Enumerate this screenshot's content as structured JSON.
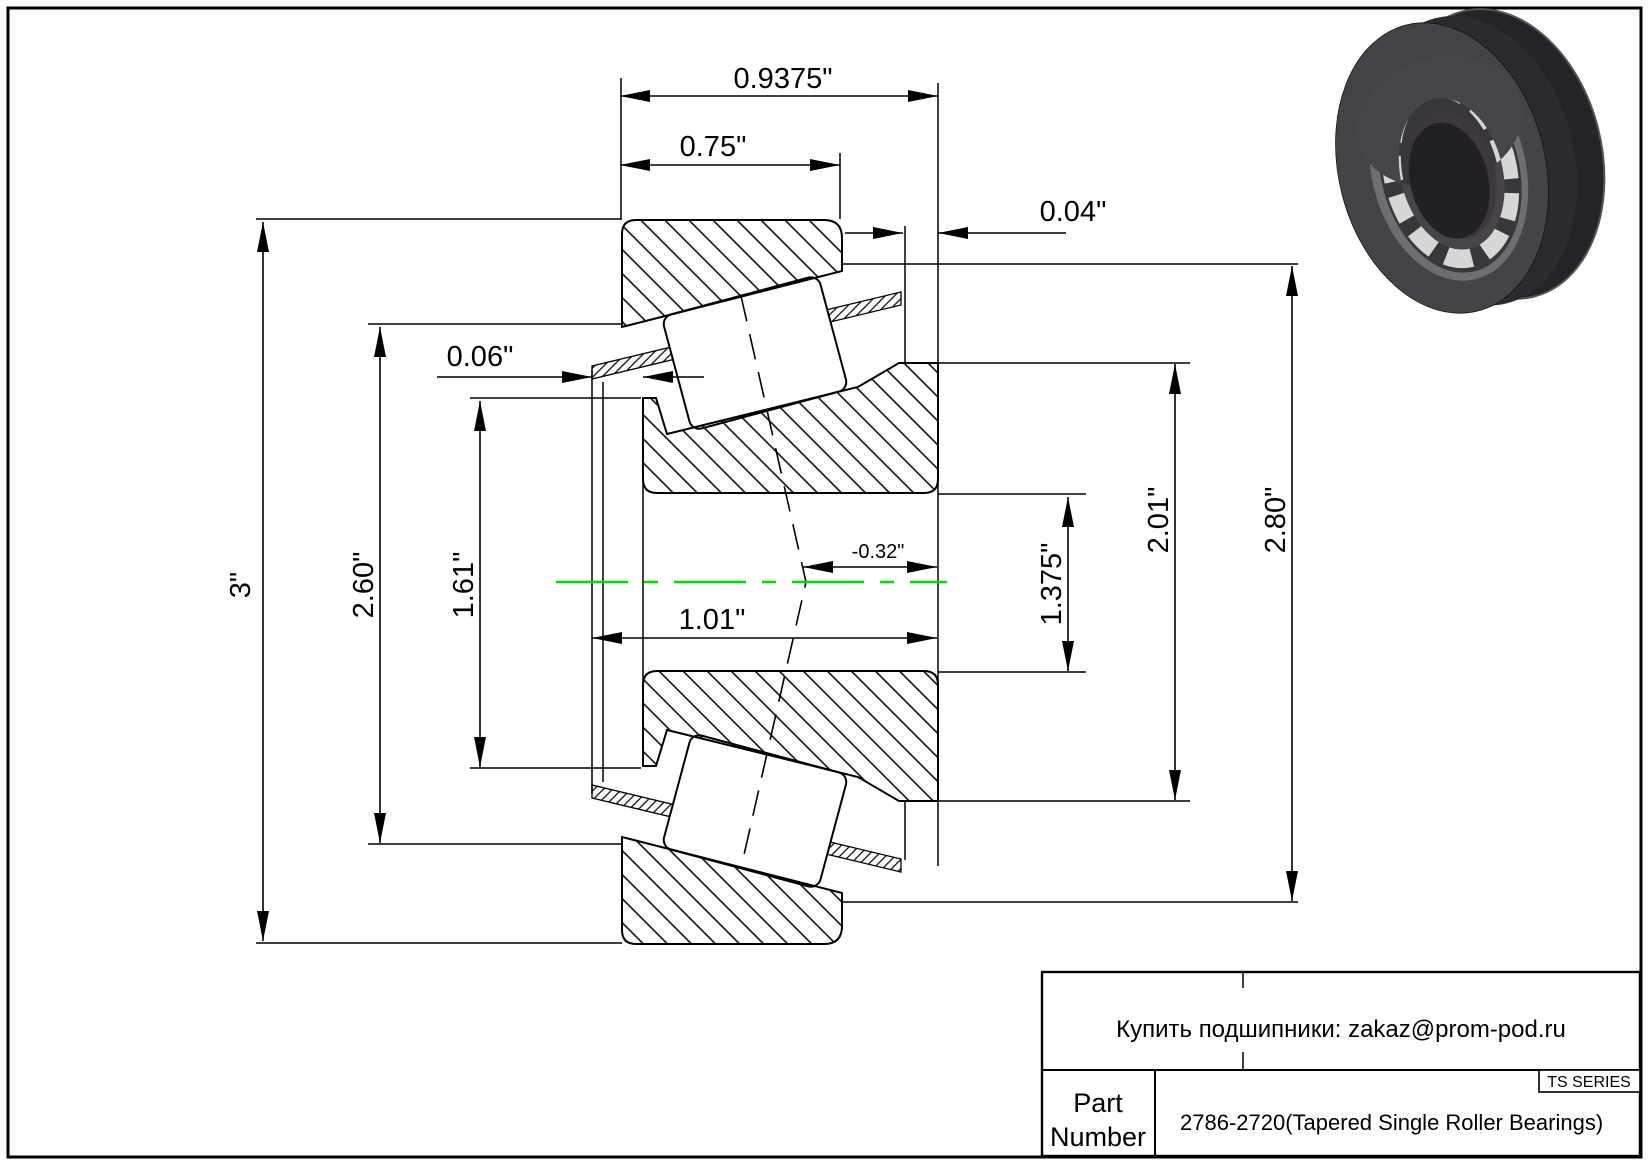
{
  "drawing": {
    "type_note": "Tapered single roller bearing cross-section drawing",
    "colors": {
      "line": "#000000",
      "centerline": "#00dd00",
      "background": "#ffffff",
      "bearing_body": "#3d3b3f",
      "bearing_rollers": "#d7d5d6"
    },
    "dimensions": {
      "horizontal": [
        {
          "id": "overall-width",
          "label": "0.9375\""
        },
        {
          "id": "cup-width",
          "label": "0.75\""
        },
        {
          "id": "back-standout",
          "label": "0.04\""
        },
        {
          "id": "front-standout",
          "label": "0.06\""
        },
        {
          "id": "cone-width",
          "label": "1.01\""
        },
        {
          "id": "center-offset",
          "label": "-0.32\""
        }
      ],
      "vertical": [
        {
          "id": "outer-diameter",
          "label": "3\""
        },
        {
          "id": "cup-inner",
          "label": "2.60\""
        },
        {
          "id": "cone-front",
          "label": "1.61\""
        },
        {
          "id": "bore-diameter",
          "label": "1.375\""
        },
        {
          "id": "cone-back",
          "label": "2.01\""
        },
        {
          "id": "cup-back",
          "label": "2.80\""
        }
      ]
    }
  },
  "title_block": {
    "contact": "Купить подшипники: zakaz@prom-pod.ru",
    "series": "TS SERIES",
    "part_label_line1": "Part",
    "part_label_line2": "Number",
    "part_number": "2786-2720(Tapered Single Roller Bearings)"
  }
}
